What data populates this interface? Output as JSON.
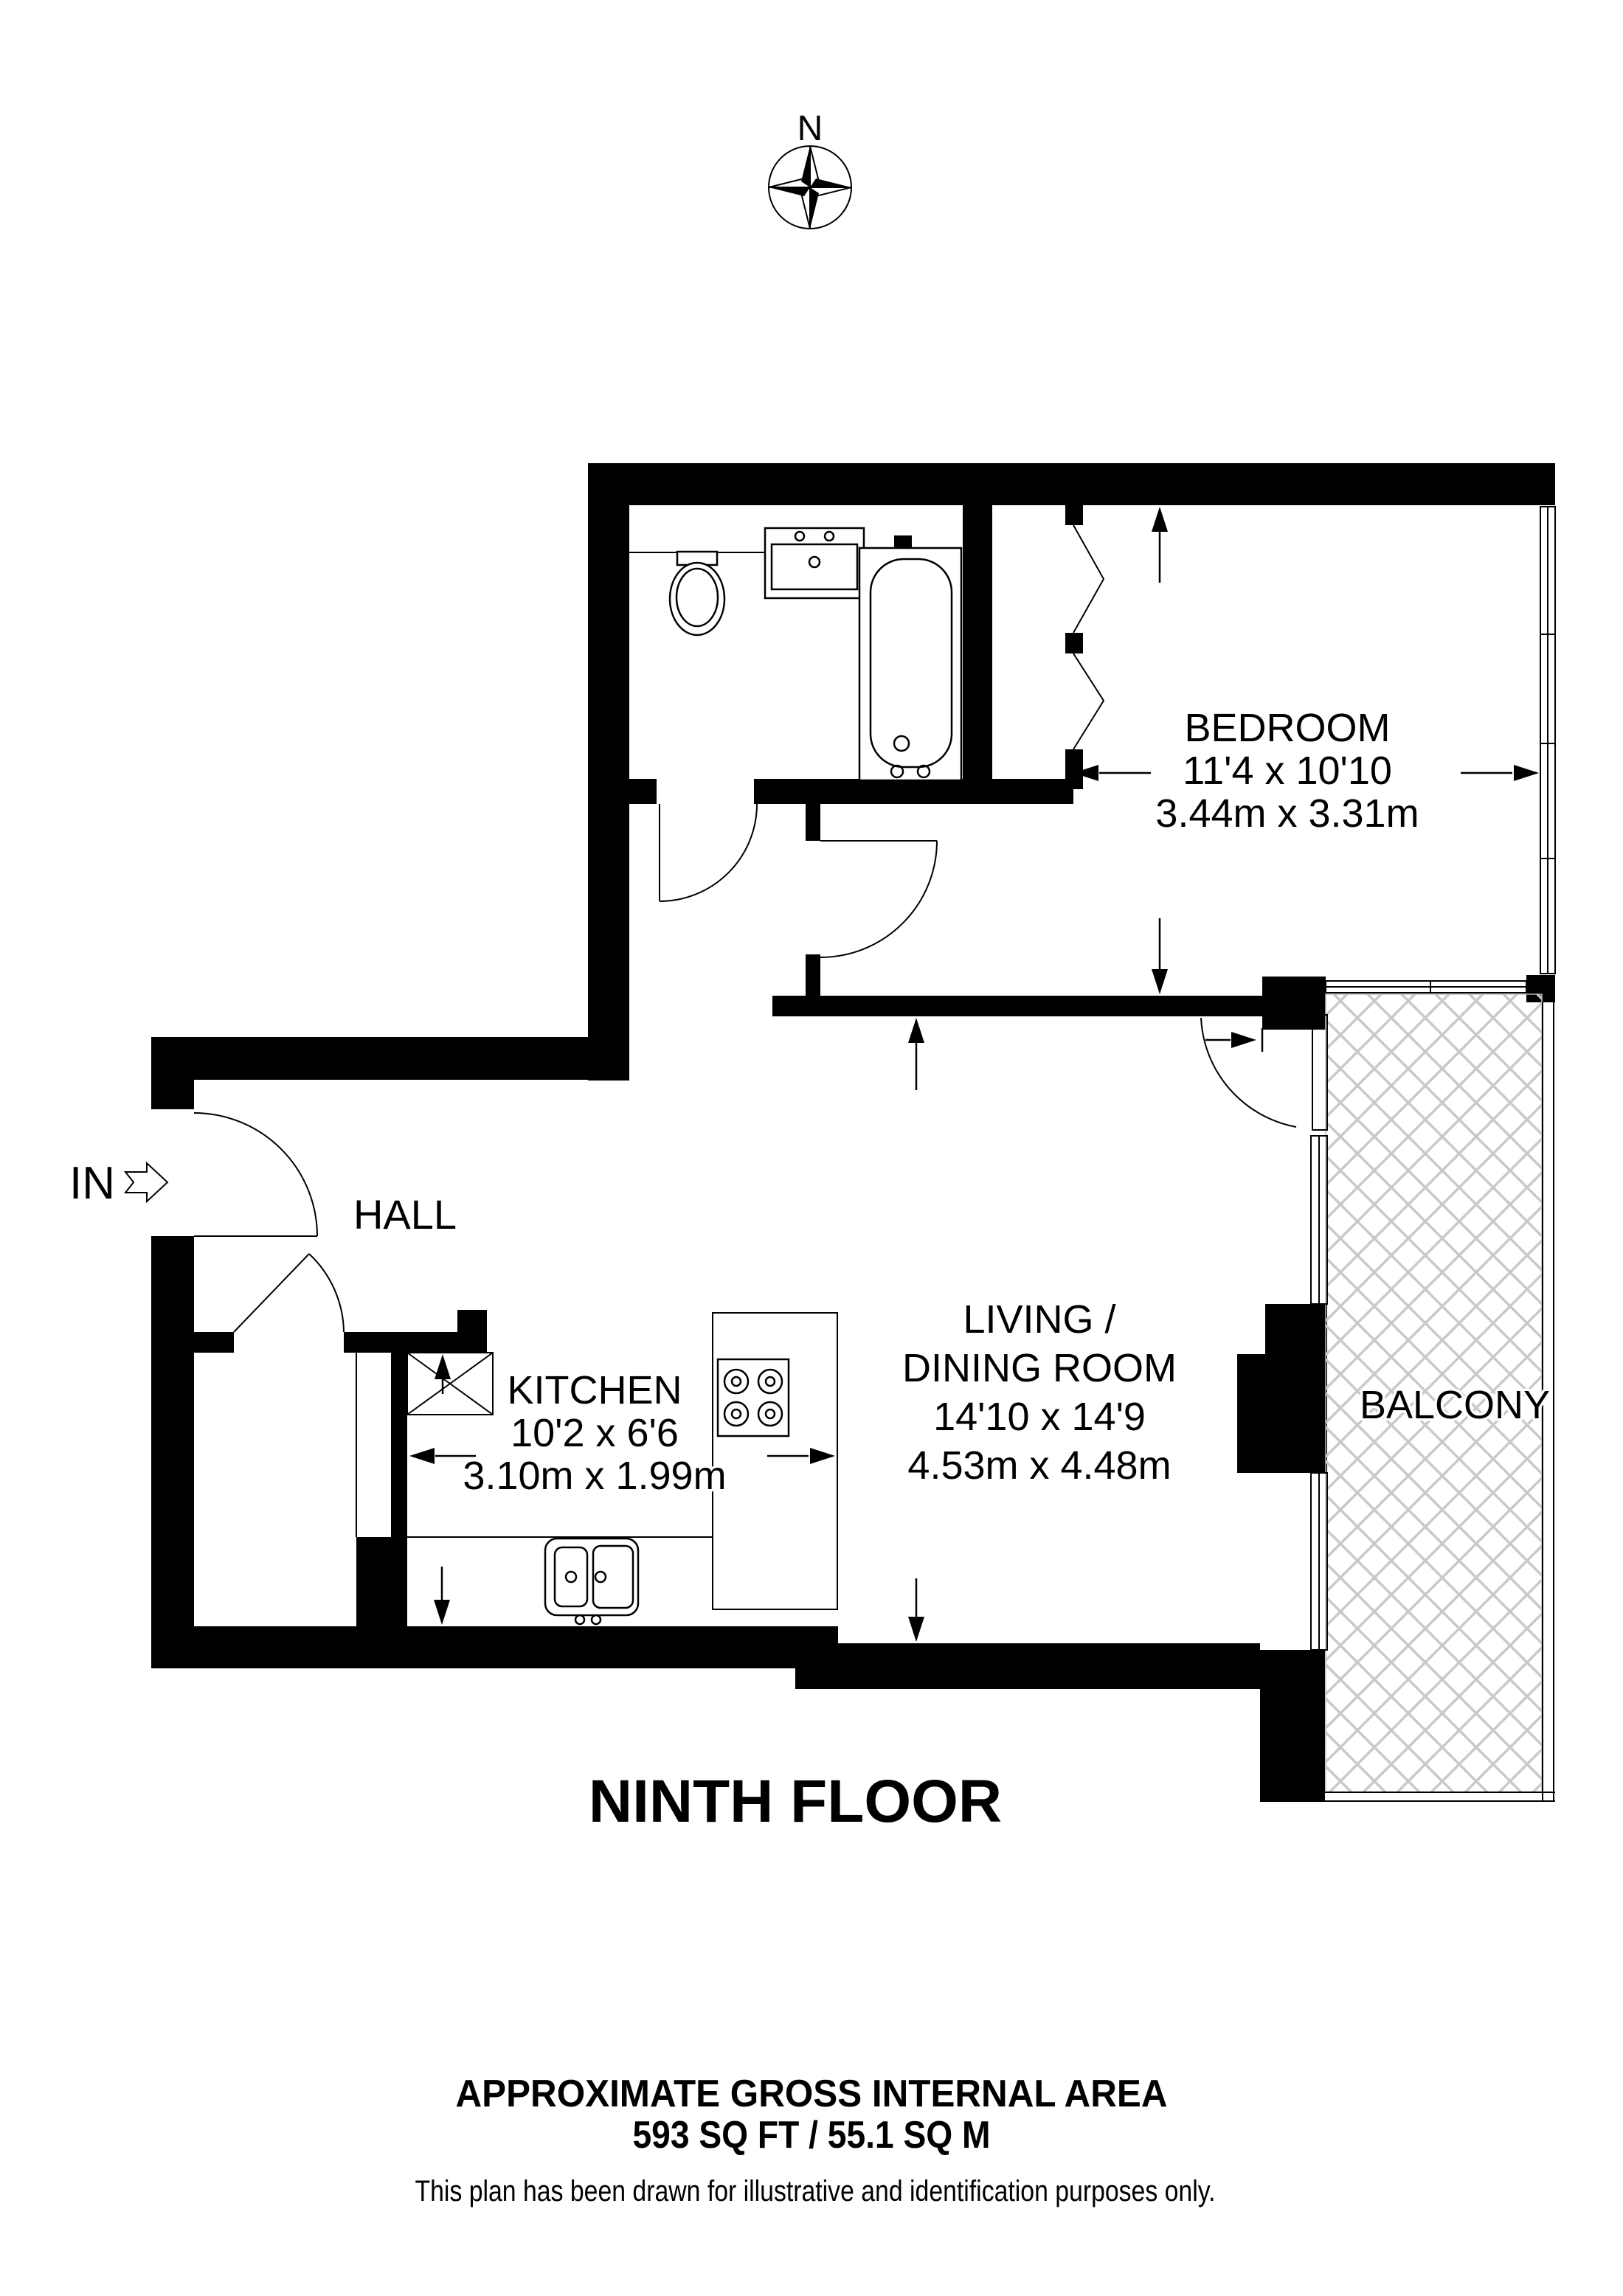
{
  "page": {
    "background": "#ffffff",
    "wall_color": "#000000",
    "hatch_color": "#c9c9c9",
    "text_color": "#000000"
  },
  "compass": {
    "label": "N"
  },
  "entry": {
    "label": "IN"
  },
  "rooms": {
    "hall": {
      "name": "HALL"
    },
    "bedroom": {
      "name": "BEDROOM",
      "imperial": "11'4 x 10'10",
      "metric": "3.44m x 3.31m"
    },
    "living": {
      "name_line1": "LIVING /",
      "name_line2": "DINING ROOM",
      "imperial": "14'10 x 14'9",
      "metric": "4.53m x 4.48m"
    },
    "kitchen": {
      "name": "KITCHEN",
      "imperial": "10'2 x 6'6",
      "metric": "3.10m x 1.99m"
    },
    "balcony": {
      "name": "BALCONY"
    }
  },
  "footer": {
    "floor_title": "NINTH FLOOR",
    "area_heading": "APPROXIMATE GROSS INTERNAL AREA",
    "area_value": "593 SQ FT / 55.1 SQ M",
    "disclaimer": "This plan has been drawn for illustrative and identification purposes only."
  }
}
